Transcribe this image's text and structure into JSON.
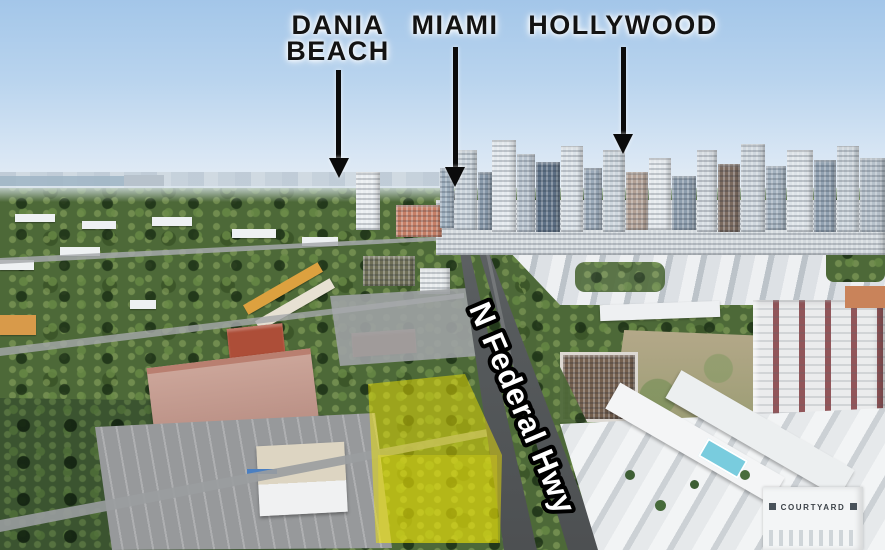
{
  "callouts": {
    "dania_beach": {
      "line1": "DANIA",
      "line2": "BEACH"
    },
    "miami": {
      "label": "MIAMI"
    },
    "hollywood": {
      "label": "HOLLYWOOD"
    }
  },
  "road": {
    "label": "N Federal Hwy"
  },
  "buildings": {
    "hotel_sign": "COURTYARD"
  },
  "colors": {
    "highlight_yellow": "#f3e500",
    "callout_text": "#131313",
    "road_label_fill": "#ffffff",
    "road_label_outline": "#000000"
  }
}
